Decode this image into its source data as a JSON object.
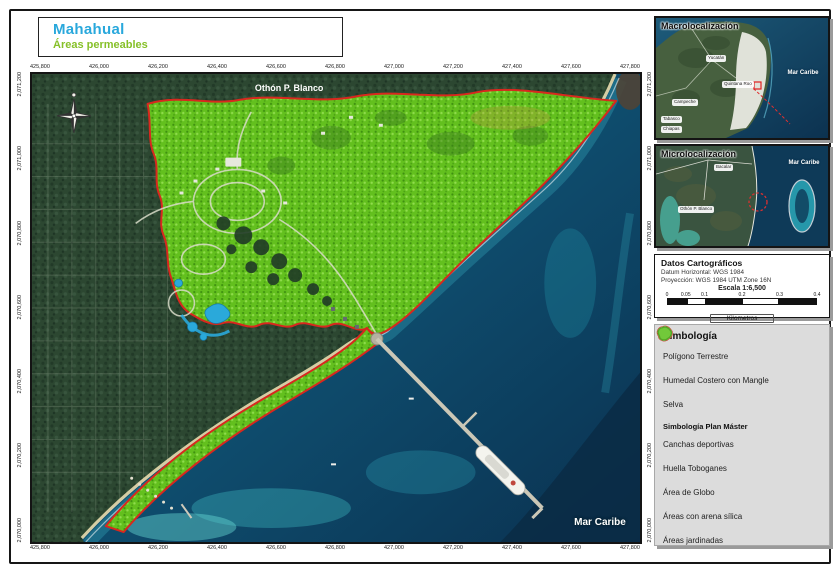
{
  "page": {
    "title": "Mahahual",
    "subtitle": "Áreas permeables"
  },
  "colors": {
    "accent_title": "#29a8dc",
    "accent_subtitle": "#86c028",
    "boundary": "#d8281e"
  },
  "map": {
    "region_label": "Othón P. Blanco",
    "sea_label": "Mar Caribe",
    "x_coords": [
      "425,800",
      "426,000",
      "426,200",
      "426,400",
      "426,600",
      "426,800",
      "427,000",
      "427,200",
      "427,400",
      "427,600",
      "427,800"
    ],
    "y_coords": [
      "2,071,200",
      "2,071,000",
      "2,070,800",
      "2,070,600",
      "2,070,400",
      "2,070,200",
      "2,070,000"
    ]
  },
  "macro": {
    "title": "Macrolocalización",
    "yucatan": "Yucatán",
    "quintana_roo": "Quintana Roo",
    "campeche": "Campeche",
    "tabasco": "Tabasco",
    "chiapas": "Chiapas",
    "sea": "Mar Caribe"
  },
  "micro": {
    "title": "Microlocalización",
    "bacalar": "Bacalar",
    "othon": "Othón P. Blanco",
    "sea": "Mar Caribe"
  },
  "datos": {
    "title": "Datos Cartográficos",
    "datum": "Datum Horizontal: WGS 1984",
    "projection": "Proyección: WGS 1984 UTM Zone 16N",
    "scale": "Escala 1:6,500",
    "ticks": [
      "0",
      "0.05",
      "0.1",
      "0.2",
      "0.3",
      "0.4"
    ],
    "units": "Kilometros"
  },
  "legend": {
    "title": "Simbología",
    "items": [
      {
        "label": "Polígono Terrestre",
        "fill": "#ffffff",
        "stroke": "#d8281e"
      },
      {
        "label": "Humedal Costero con Mangle",
        "fill": "#86c94c",
        "stroke": "#5da32b"
      },
      {
        "label": "Selva",
        "fill": "#ecdfa8",
        "stroke": "#d9c178"
      }
    ],
    "master_title": "Simbología Plan Máster",
    "master_items": [
      {
        "label": "Canchas deportivas",
        "fill": "#ea3fc0",
        "stroke": "#c92da4"
      },
      {
        "label": "Huella Toboganes",
        "fill": "#f2f2ee",
        "stroke": "#9aa3b5"
      },
      {
        "label": "Área de Globo",
        "fill": "#b9cfe8",
        "stroke": "#88a6cc"
      },
      {
        "label": "Áreas con arena sílica",
        "fill": "#f7efcd",
        "stroke": "#e3d7a6"
      },
      {
        "label": "Áreas jardinadas",
        "fill": "#72c93a",
        "stroke": "#55a626"
      }
    ]
  }
}
